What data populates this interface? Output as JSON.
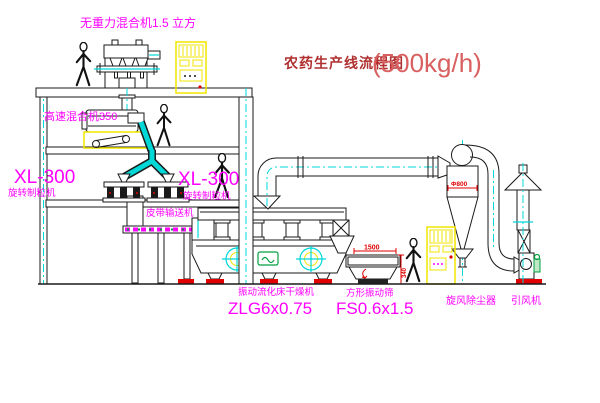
{
  "title": {
    "text": "农药生产线流程图",
    "capacity": "(500kg/h)"
  },
  "equipment_labels": {
    "gravity_mixer": "无重力混合机1.5 立方",
    "high_speed_mixer": "高速混合机350",
    "granulator_left": {
      "model": "XL-300",
      "name": "旋转制粒机"
    },
    "granulator_right": {
      "model": "XL-300",
      "name": "旋转制粒机"
    },
    "belt_conveyor": "皮带输送机",
    "fluid_bed_dryer": {
      "name": "振动流化床干燥机",
      "model": "ZLG6x0.75"
    },
    "vibrating_sieve": {
      "name": "方形振动筛",
      "model": "FS0.6x1.5"
    },
    "cyclone_dust_collector": "旋风除尘器",
    "induced_draft_fan": "引风机"
  },
  "dimensions": {
    "sieve_length": "1500",
    "sieve_height": "340",
    "cyclone_diameter": "Φ800"
  },
  "colors": {
    "label_magenta": "#ff00ff",
    "pipe_cyan": "#00d8d8",
    "highlight_yellow": "#f2e500",
    "dimension_red": "#e00000",
    "title_red": "#b03030",
    "capacity_red": "#d96060",
    "motor_green": "#00a040",
    "line_black": "#1a1a1a",
    "background": "#ffffff"
  }
}
